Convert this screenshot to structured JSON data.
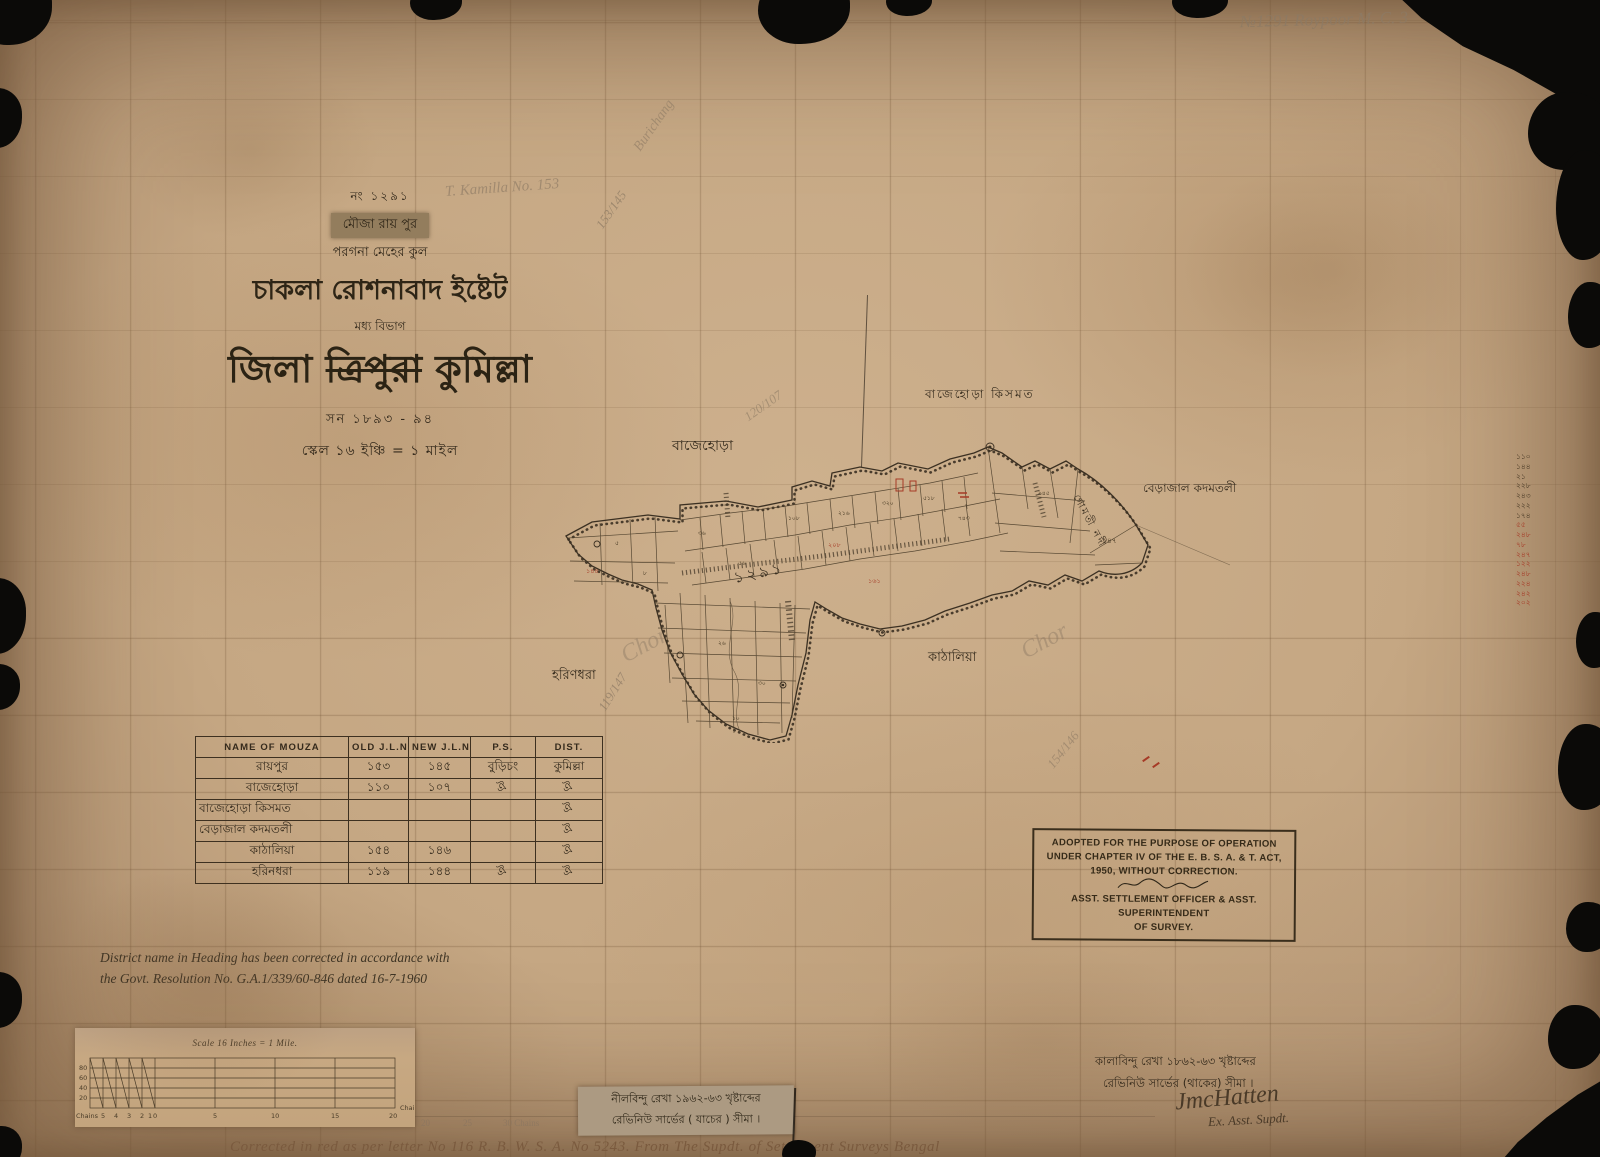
{
  "pencil_notes": {
    "top_right": "№1291  Roypoor  M. C.  3",
    "kamilla": "T. Kamilla No. 153",
    "fraction_title": "153/145",
    "burichang": "Burichang",
    "fraction_bajehora": "120/107",
    "fraction_harindhara": "119/147",
    "fraction_kathalia": "154/146",
    "scribble_left": "Chor",
    "scribble_right": "Chor"
  },
  "title_block": {
    "number": "নং ১২৯১",
    "mouza_label": "মৌজা রায় পুর",
    "pargana": "পরগনা মেহের কুল",
    "estate": "চাকলা রোশনাবাদ ইষ্টেট",
    "division": "মধ্য বিভাগ",
    "district_prefix": "জিলা",
    "district_struck": "ত্রিপুরা",
    "district_new": "কুমিল্লা",
    "year": "সন ১৮৯৩ - ৯৪",
    "scale": "স্কেল ১৬ ইঞ্চি = ১ মাইল"
  },
  "map": {
    "labels": {
      "bajehora": "বাজেহোড়া",
      "bajehora_kismat": "বাজেহোড়া কিসমত",
      "berajal": "বেড়াজাল কদমতলী",
      "river": "গোমতী নদী",
      "harindhara": "হরিণধরা",
      "kathalia": "কাঠালিয়া"
    },
    "sheet_number": "১২৯১",
    "plot_numbers": [
      "৫",
      "৮",
      "৩৬",
      "৫৬",
      "১০৮",
      "২১৬",
      "৩২০",
      "৫১৮",
      "৭৪৩",
      "৯৪৫",
      "১৪৭",
      "২৬",
      "৩০",
      "১০"
    ],
    "red_numbers": [
      "২০৮",
      "১৬১",
      "১৪৪"
    ]
  },
  "mouza_table": {
    "headers": [
      "NAME OF MOUZA",
      "OLD J.L.NO",
      "NEW J.L.NO",
      "P.S.",
      "DIST."
    ],
    "rows": [
      {
        "name": "রায়পুর",
        "old": "১৫৩",
        "new": "১৪৫",
        "ps": "বুড়িচং",
        "dist": "কুমিল্লা"
      },
      {
        "name": "বাজেহোড়া",
        "old": "১১০",
        "new": "১০৭",
        "ps": "ঐ",
        "dist": "ঐ"
      },
      {
        "name": "বাজেহোড়া কিসমত",
        "old": "",
        "new": "",
        "ps": "",
        "dist": "ঐ"
      },
      {
        "name": "বেড়াজাল কদমতলী",
        "old": "",
        "new": "",
        "ps": "",
        "dist": "ঐ"
      },
      {
        "name": "কাঠালিয়া",
        "old": "১৫৪",
        "new": "১৪৬",
        "ps": "",
        "dist": "ঐ"
      },
      {
        "name": "হরিনধরা",
        "old": "১১৯",
        "new": "১৪৪",
        "ps": "ঐ",
        "dist": "ঐ"
      }
    ]
  },
  "stamp": {
    "line1": "ADOPTED FOR THE PURPOSE OF OPERATION",
    "line2": "UNDER CHAPTER IV OF THE E. B. S. A. & T. ACT,",
    "line3": "1950, WITHOUT CORRECTION.",
    "line4": "ASST. SETTLEMENT OFFICER & ASST. SUPERINTENDENT",
    "line5": "OF SURVEY."
  },
  "correction_note": {
    "line1": "District name in Heading has been corrected in accordance with",
    "line2": "the Govt. Resolution No. G.A.1/339/60-846 dated 16-7-1960"
  },
  "scale_bar": {
    "title": "Scale 16 Inches = 1 Mile.",
    "left_labels": [
      "80",
      "60",
      "40",
      "20"
    ],
    "sub_labels": [
      "5",
      "4",
      "3",
      "2",
      "1",
      "0"
    ],
    "main_labels": [
      "5",
      "10",
      "15",
      "20"
    ],
    "unit_left": "Chains",
    "unit_right": "Chains",
    "ext_labels": [
      "20",
      "25",
      "30 Chains"
    ]
  },
  "slip_label": {
    "line1": "নীলবিন্দু রেখা ১৯৬২-৬৩ খৃষ্টাব্দের",
    "line2": "রেভিনিউ সার্ভের ( যাচের ) সীমা ।"
  },
  "legend_right": {
    "line1": "কালাবিন্দু রেখা ১৮৬২-৬৩ খৃষ্টাব্দের",
    "line2": "রেভিনিউ সার্ভের (থাকের) সীমা ।",
    "signature": "JmcHatten",
    "sig_title": "Ex. Asst. Supdt."
  },
  "bottom_note": "Corrected in red as per letter No 116 R. B. W. S. A. No 5243. From The Supdt. of Settlement Surveys Bengal",
  "edge_numbers": [
    "১১০",
    "১৪৪",
    "২১",
    "২২৮",
    "২৪৩",
    "২২২",
    "১৭৪",
    "৫৫",
    "২৪৮",
    "৭৮",
    "২৪৭",
    "১২২",
    "২৪৮",
    "২২৪",
    "২৪২",
    "২০২"
  ],
  "colors": {
    "red_ink": "#a63a26",
    "black_ink": "#3a2f20",
    "pencil": "#8d7a64"
  }
}
